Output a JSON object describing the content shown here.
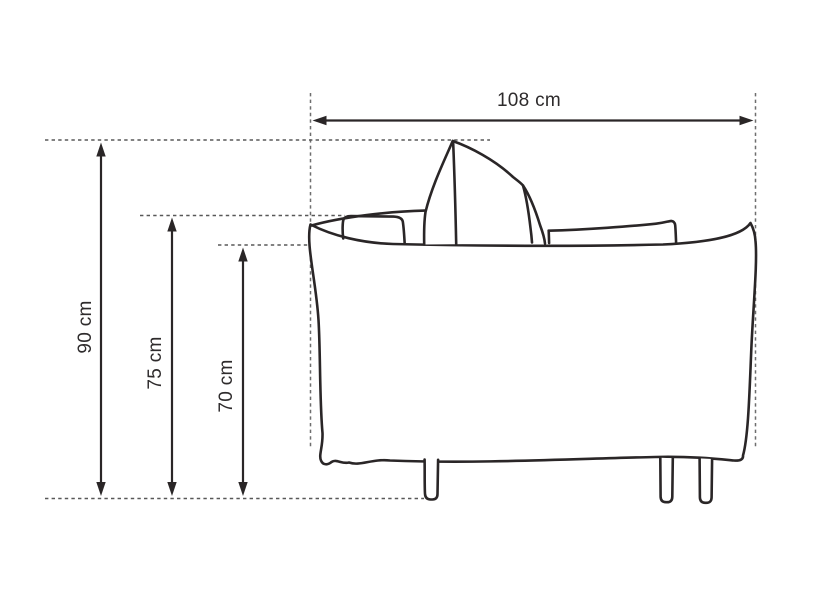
{
  "diagram": {
    "subject": "sofa-side-view-dimension-drawing",
    "colors": {
      "line": "#2a2627",
      "guide": "#6e6e6e",
      "text": "#2e2b2c",
      "background": "#ffffff"
    },
    "dimensions": [
      {
        "id": "overall-width",
        "label": "108 cm",
        "value": 108,
        "unit": "cm",
        "orientation": "horizontal"
      },
      {
        "id": "overall-height",
        "label": "90 cm",
        "value": 90,
        "unit": "cm",
        "orientation": "vertical"
      },
      {
        "id": "armrest-height",
        "label": "75 cm",
        "value": 75,
        "unit": "cm",
        "orientation": "vertical"
      },
      {
        "id": "body-height",
        "label": "70 cm",
        "value": 70,
        "unit": "cm",
        "orientation": "vertical"
      }
    ]
  }
}
